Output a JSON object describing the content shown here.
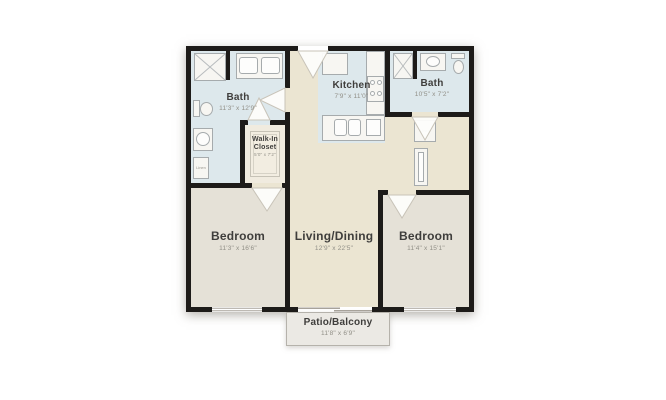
{
  "floorplan": {
    "rooms": {
      "bath_left": {
        "label": "Bath",
        "dims": "11'3\" x 12'9\""
      },
      "walk_in_closet": {
        "label": "Walk-In Closet",
        "dims": "5'0\" x 7'2\""
      },
      "kitchen": {
        "label": "Kitchen",
        "dims": "7'9\" x 11'0\""
      },
      "bath_right": {
        "label": "Bath",
        "dims": "10'5\" x 7'2\""
      },
      "bedroom_left": {
        "label": "Bedroom",
        "dims": "11'3\" x 16'6\""
      },
      "living_dining": {
        "label": "Living/Dining",
        "dims": "12'9\" x 22'5\""
      },
      "bedroom_right": {
        "label": "Bedroom",
        "dims": "11'4\" x 15'1\""
      },
      "patio": {
        "label": "Patio/Balcony",
        "dims": "11'8\" x 6'9\""
      },
      "linen": {
        "label": "Linen"
      }
    },
    "colors": {
      "wall": "#1d1b19",
      "wet_room_floor": "#dde8ec",
      "living_floor": "#ebe5d2",
      "bedroom_floor": "#e5e1d7",
      "closet_floor": "#f0ebdf",
      "patio_floor": "#ebe9e4",
      "fixture_fill": "#f7f6f2",
      "fixture_border": "#a6abad",
      "room_label_text": "#3f3e3c",
      "dimension_text": "#918f87"
    },
    "icons": [
      "shower-icon",
      "double-vanity-icon",
      "toilet-icon",
      "washer-icon",
      "fridge-icon",
      "stove-icon",
      "kitchen-sink-icon",
      "dishwasher-icon",
      "vanity-sink-icon",
      "door-swing-icon",
      "window-icon",
      "closet-rug-icon",
      "linen-cabinet-icon"
    ]
  }
}
